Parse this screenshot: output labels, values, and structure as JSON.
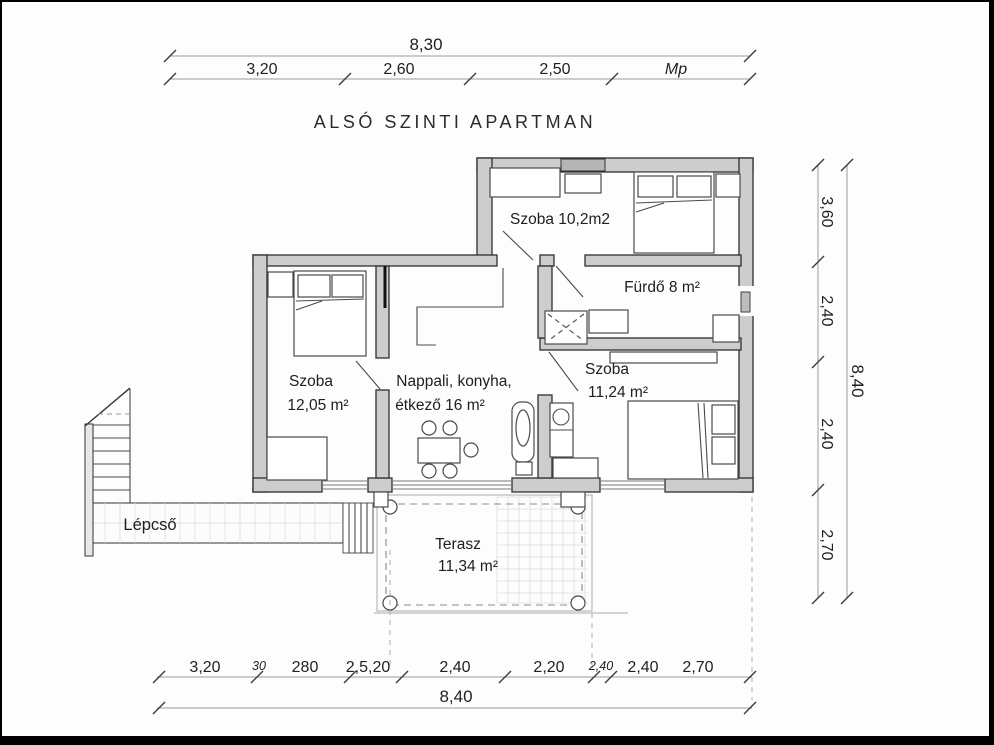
{
  "title": "ALSÓ SZINTI APARTMAN",
  "dims": {
    "top": {
      "total": "8,30",
      "segments": [
        "3,20",
        "2,60",
        "2,50",
        "Mp"
      ]
    },
    "right": {
      "total": "8,40",
      "segments": [
        "3,60",
        "2,40",
        "2,40",
        "2,70"
      ]
    },
    "bottom": {
      "total": "8,40",
      "segments": [
        "3,20",
        "30",
        "280",
        "2,5,20",
        "2,40",
        "2,20",
        "2,40",
        "2,40",
        "2,70"
      ]
    }
  },
  "rooms": {
    "szoba_upper": {
      "label": "Szoba 10,2m2"
    },
    "furdo": {
      "label": "Fürdő 8 m²"
    },
    "szoba_left": {
      "name": "Szoba",
      "area": "12,05 m²"
    },
    "nappali": {
      "name": "Nappali, konyha,",
      "area": "étkező 16 m²"
    },
    "szoba_right": {
      "name": "Szoba",
      "area": "11,24 m²"
    },
    "terasz": {
      "name": "Terasz",
      "area": "11,34 m²"
    },
    "lepcso": {
      "label": "Lépcső"
    }
  },
  "colors": {
    "wall_fill": "#cdcdcd",
    "wall_stroke": "#2f2f2f",
    "dim_line": "#9a9a9a",
    "text": "#1f1f1f",
    "frame": "#000000"
  }
}
